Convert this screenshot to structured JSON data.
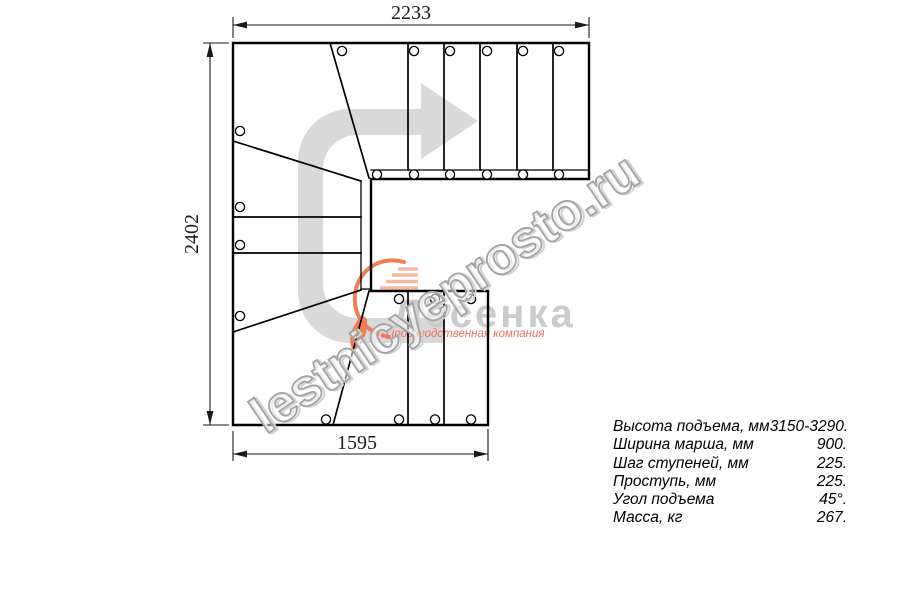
{
  "drawing": {
    "dimensions": {
      "top": "2233",
      "left": "2402",
      "bottom": "1595"
    },
    "line_color": "#000000",
    "arrow_color": "#d9d9d9"
  },
  "watermark": {
    "text": "lestnicyeprosto.ru"
  },
  "logo": {
    "name": "Лесенка",
    "tagline": "Производственная компания",
    "accent_color": "#e8735a"
  },
  "specs": {
    "rows": [
      {
        "label": "Высота подъема, мм",
        "value": "3150-3290."
      },
      {
        "label": "Ширина марша, мм",
        "value": "900."
      },
      {
        "label": "Шаг ступеней, мм",
        "value": "225."
      },
      {
        "label": "Проступь, мм",
        "value": "225."
      },
      {
        "label": "Угол подъема",
        "value": "45°."
      },
      {
        "label": "Масса, кг",
        "value": "267."
      }
    ]
  }
}
